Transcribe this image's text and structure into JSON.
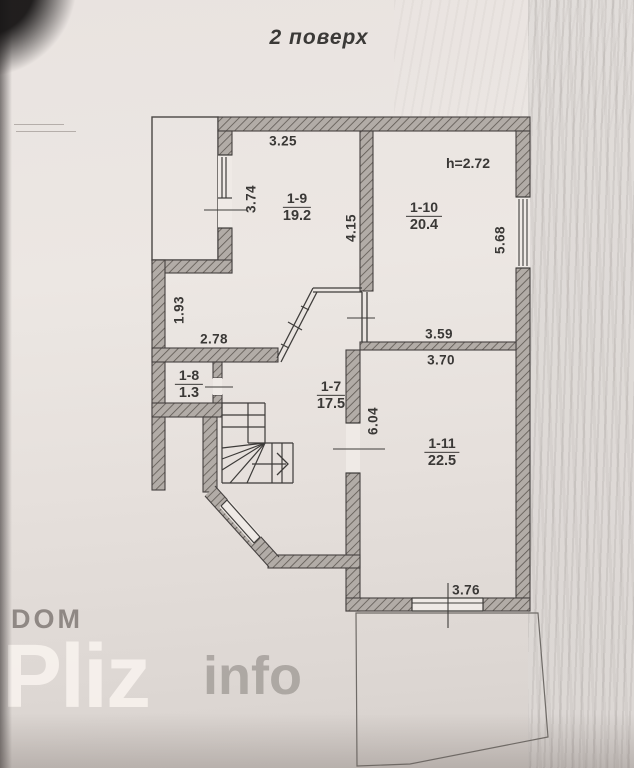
{
  "title": "2 поверх",
  "plan": {
    "height_note": "h=2.72",
    "rooms": [
      {
        "id": "1-7",
        "area": "17.5"
      },
      {
        "id": "1-8",
        "area": "1.3"
      },
      {
        "id": "1-9",
        "area": "19.2"
      },
      {
        "id": "1-10",
        "area": "20.4"
      },
      {
        "id": "1-11",
        "area": "22.5"
      }
    ],
    "dims": {
      "w_19_top": "3.25",
      "w_19_left": "3.74",
      "w_mid": "4.15",
      "w_110_right": "5.68",
      "w_step_left": "1.93",
      "w_hall_left": "2.78",
      "w_111_above": "3.59",
      "w_111_top": "3.70",
      "w_111_left": "6.04",
      "w_111_bottom": "3.76"
    }
  },
  "watermark": {
    "dom": "DOM",
    "pliz": "Pliz",
    "info": "info"
  }
}
